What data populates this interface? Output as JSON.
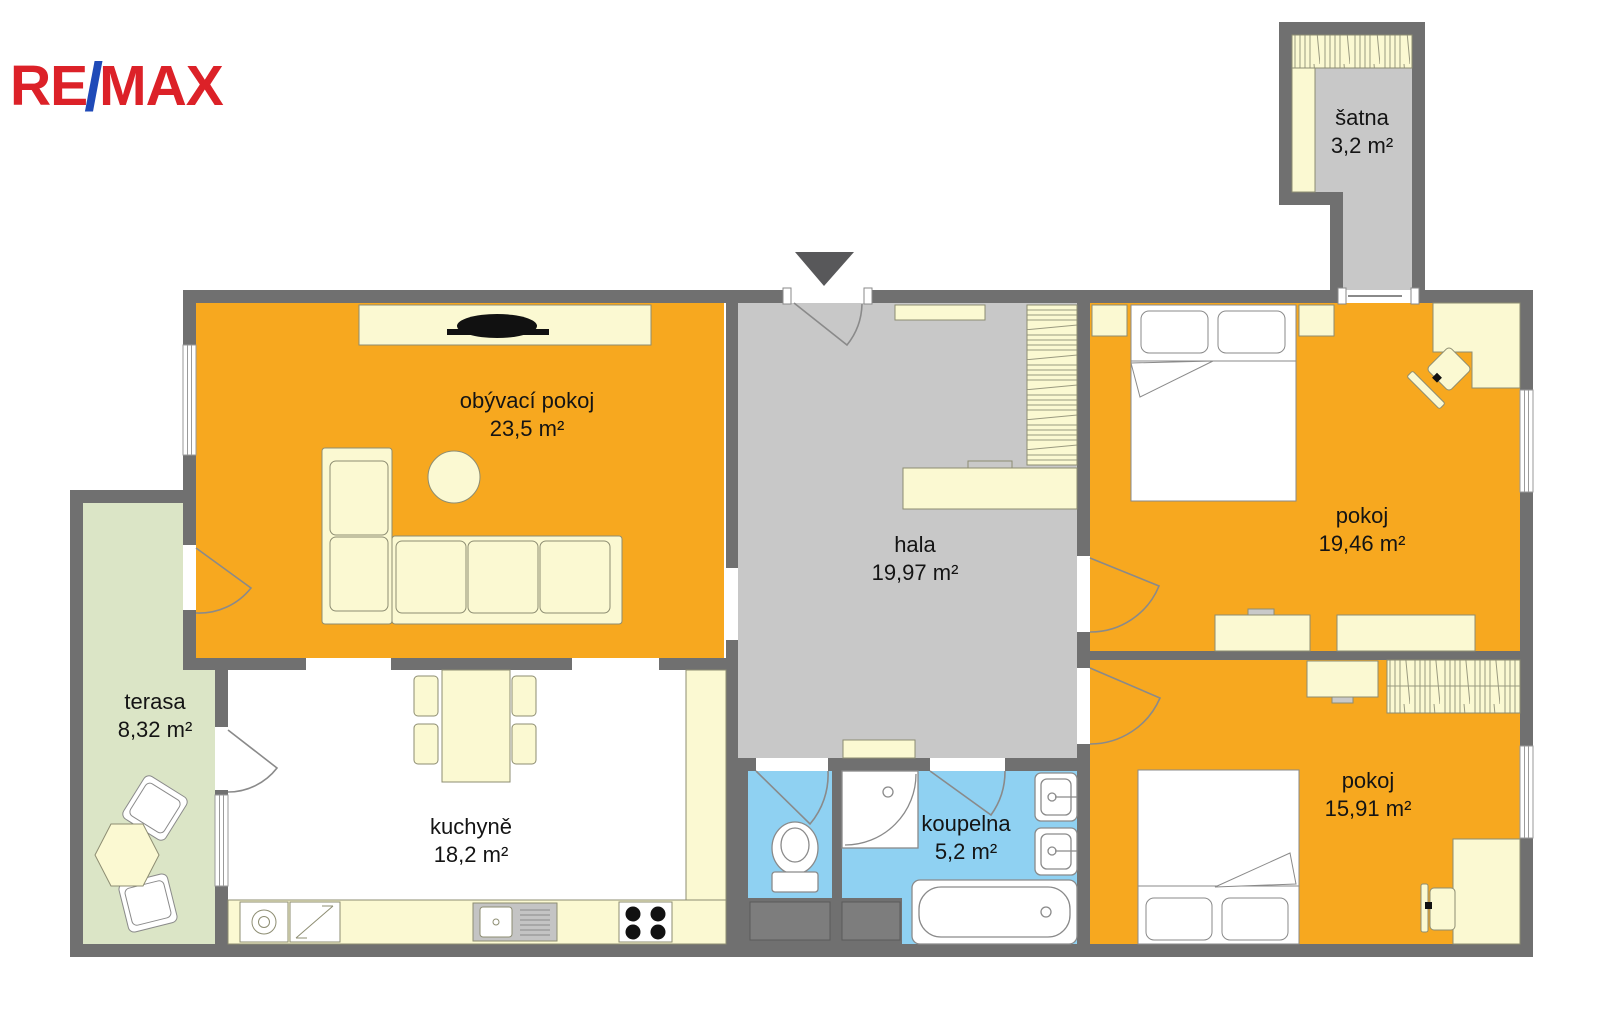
{
  "brand": {
    "re": "RE",
    "slash": "/",
    "max": "MAX",
    "red": "#DC2128",
    "blue": "#1F4AB8"
  },
  "rooms": [
    {
      "id": "obyvaci-pokoj",
      "name": "obývací pokoj",
      "area": "23,5 m²"
    },
    {
      "id": "hala",
      "name": "hala",
      "area": "19,97 m²"
    },
    {
      "id": "pokoj-1",
      "name": "pokoj",
      "area": "19,46 m²"
    },
    {
      "id": "pokoj-2",
      "name": "pokoj",
      "area": "15,91 m²"
    },
    {
      "id": "kuchyne",
      "name": "kuchyně",
      "area": "18,2 m²"
    },
    {
      "id": "koupelna",
      "name": "koupelna",
      "area": "5,2 m²"
    },
    {
      "id": "terasa",
      "name": "terasa",
      "area": "8,32 m²"
    },
    {
      "id": "satna",
      "name": "šatna",
      "area": "3,2 m²"
    }
  ],
  "icons": {
    "entrance": "entrance-arrow-down"
  },
  "colors": {
    "room_orange": "#F7A81F",
    "floor_gray": "#C8C8C8",
    "bathroom_blue": "#8FD1F2",
    "terrace_green": "#DBE5C6",
    "furniture_cream": "#FBF9D2",
    "wall_gray": "#707070",
    "kitchen_white": "#FFFFFF"
  }
}
